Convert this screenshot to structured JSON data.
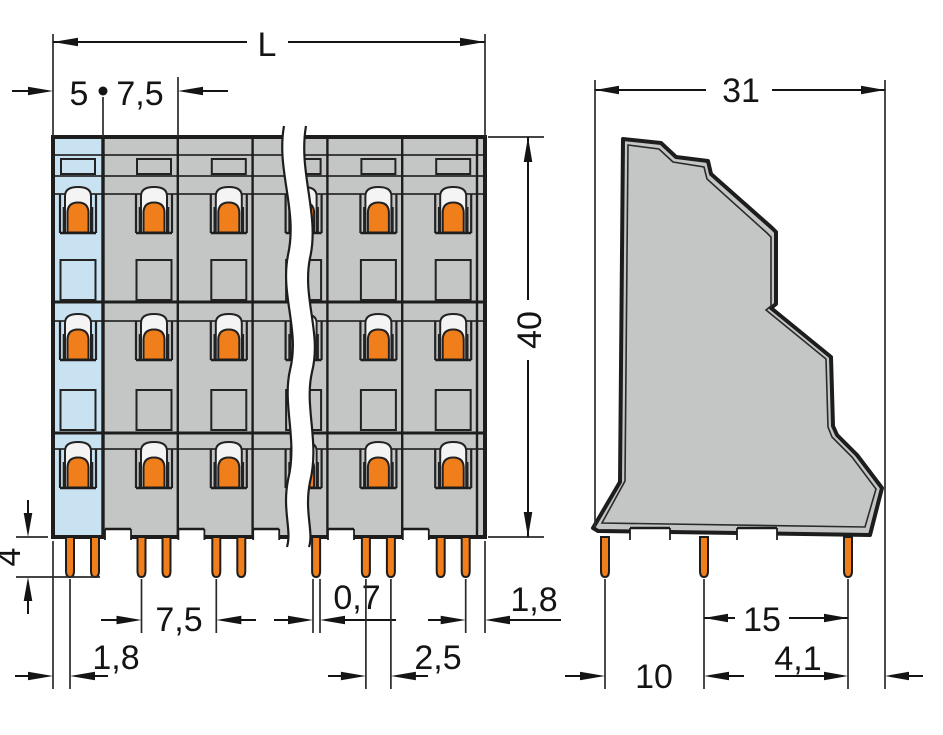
{
  "drawing": {
    "type": "technical-dimension-drawing",
    "views": [
      "front-view",
      "side-view"
    ]
  },
  "colors": {
    "background": "#ffffff",
    "housing_gray": "#c3c6c4",
    "end_section_blue": "#c9e2f1",
    "clamp_orange": "#ef7e1b",
    "dome_light": "#f3f4f3",
    "line": "#1d1d1d"
  },
  "front_view": {
    "dims": {
      "total_length": "L",
      "end_section_width": "5",
      "pole_pitch": "7,5",
      "height": "40",
      "pin_length": "4",
      "pin_offset_left": "1,8",
      "pin_pitch": "7,5",
      "pin_width": "0,7",
      "pin_pair_spacing": "2,5",
      "pin_offset_right": "1,8"
    }
  },
  "side_view": {
    "dims": {
      "depth": "31",
      "pin_row1_offset": "10",
      "pin_row_spacing": "15",
      "pin_foot_offset": "4,1"
    }
  }
}
